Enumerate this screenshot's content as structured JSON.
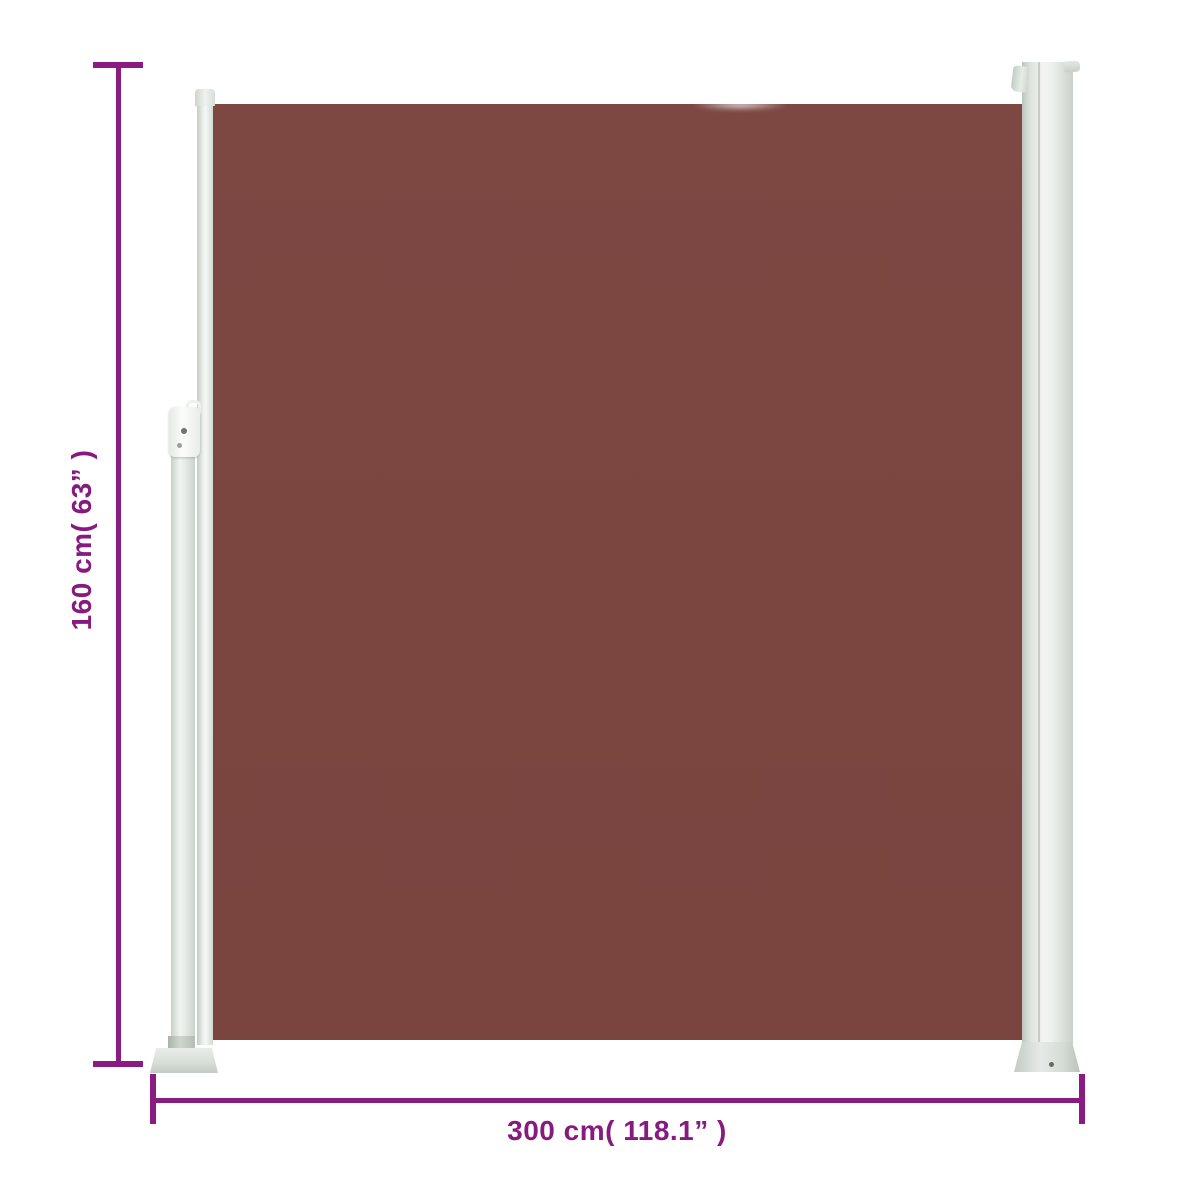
{
  "diagram": {
    "type": "product-dimension-diagram",
    "subject": "retractable-side-awning",
    "fabric_color": "#7b4540",
    "frame_color": "#dde3dd",
    "accent_color": "#8a1b80",
    "background_color": "#ffffff",
    "height_label": "160 cm( 63” )",
    "width_label": "300 cm( 118.1” )",
    "height_value_cm": 160,
    "width_value_cm": 300
  }
}
